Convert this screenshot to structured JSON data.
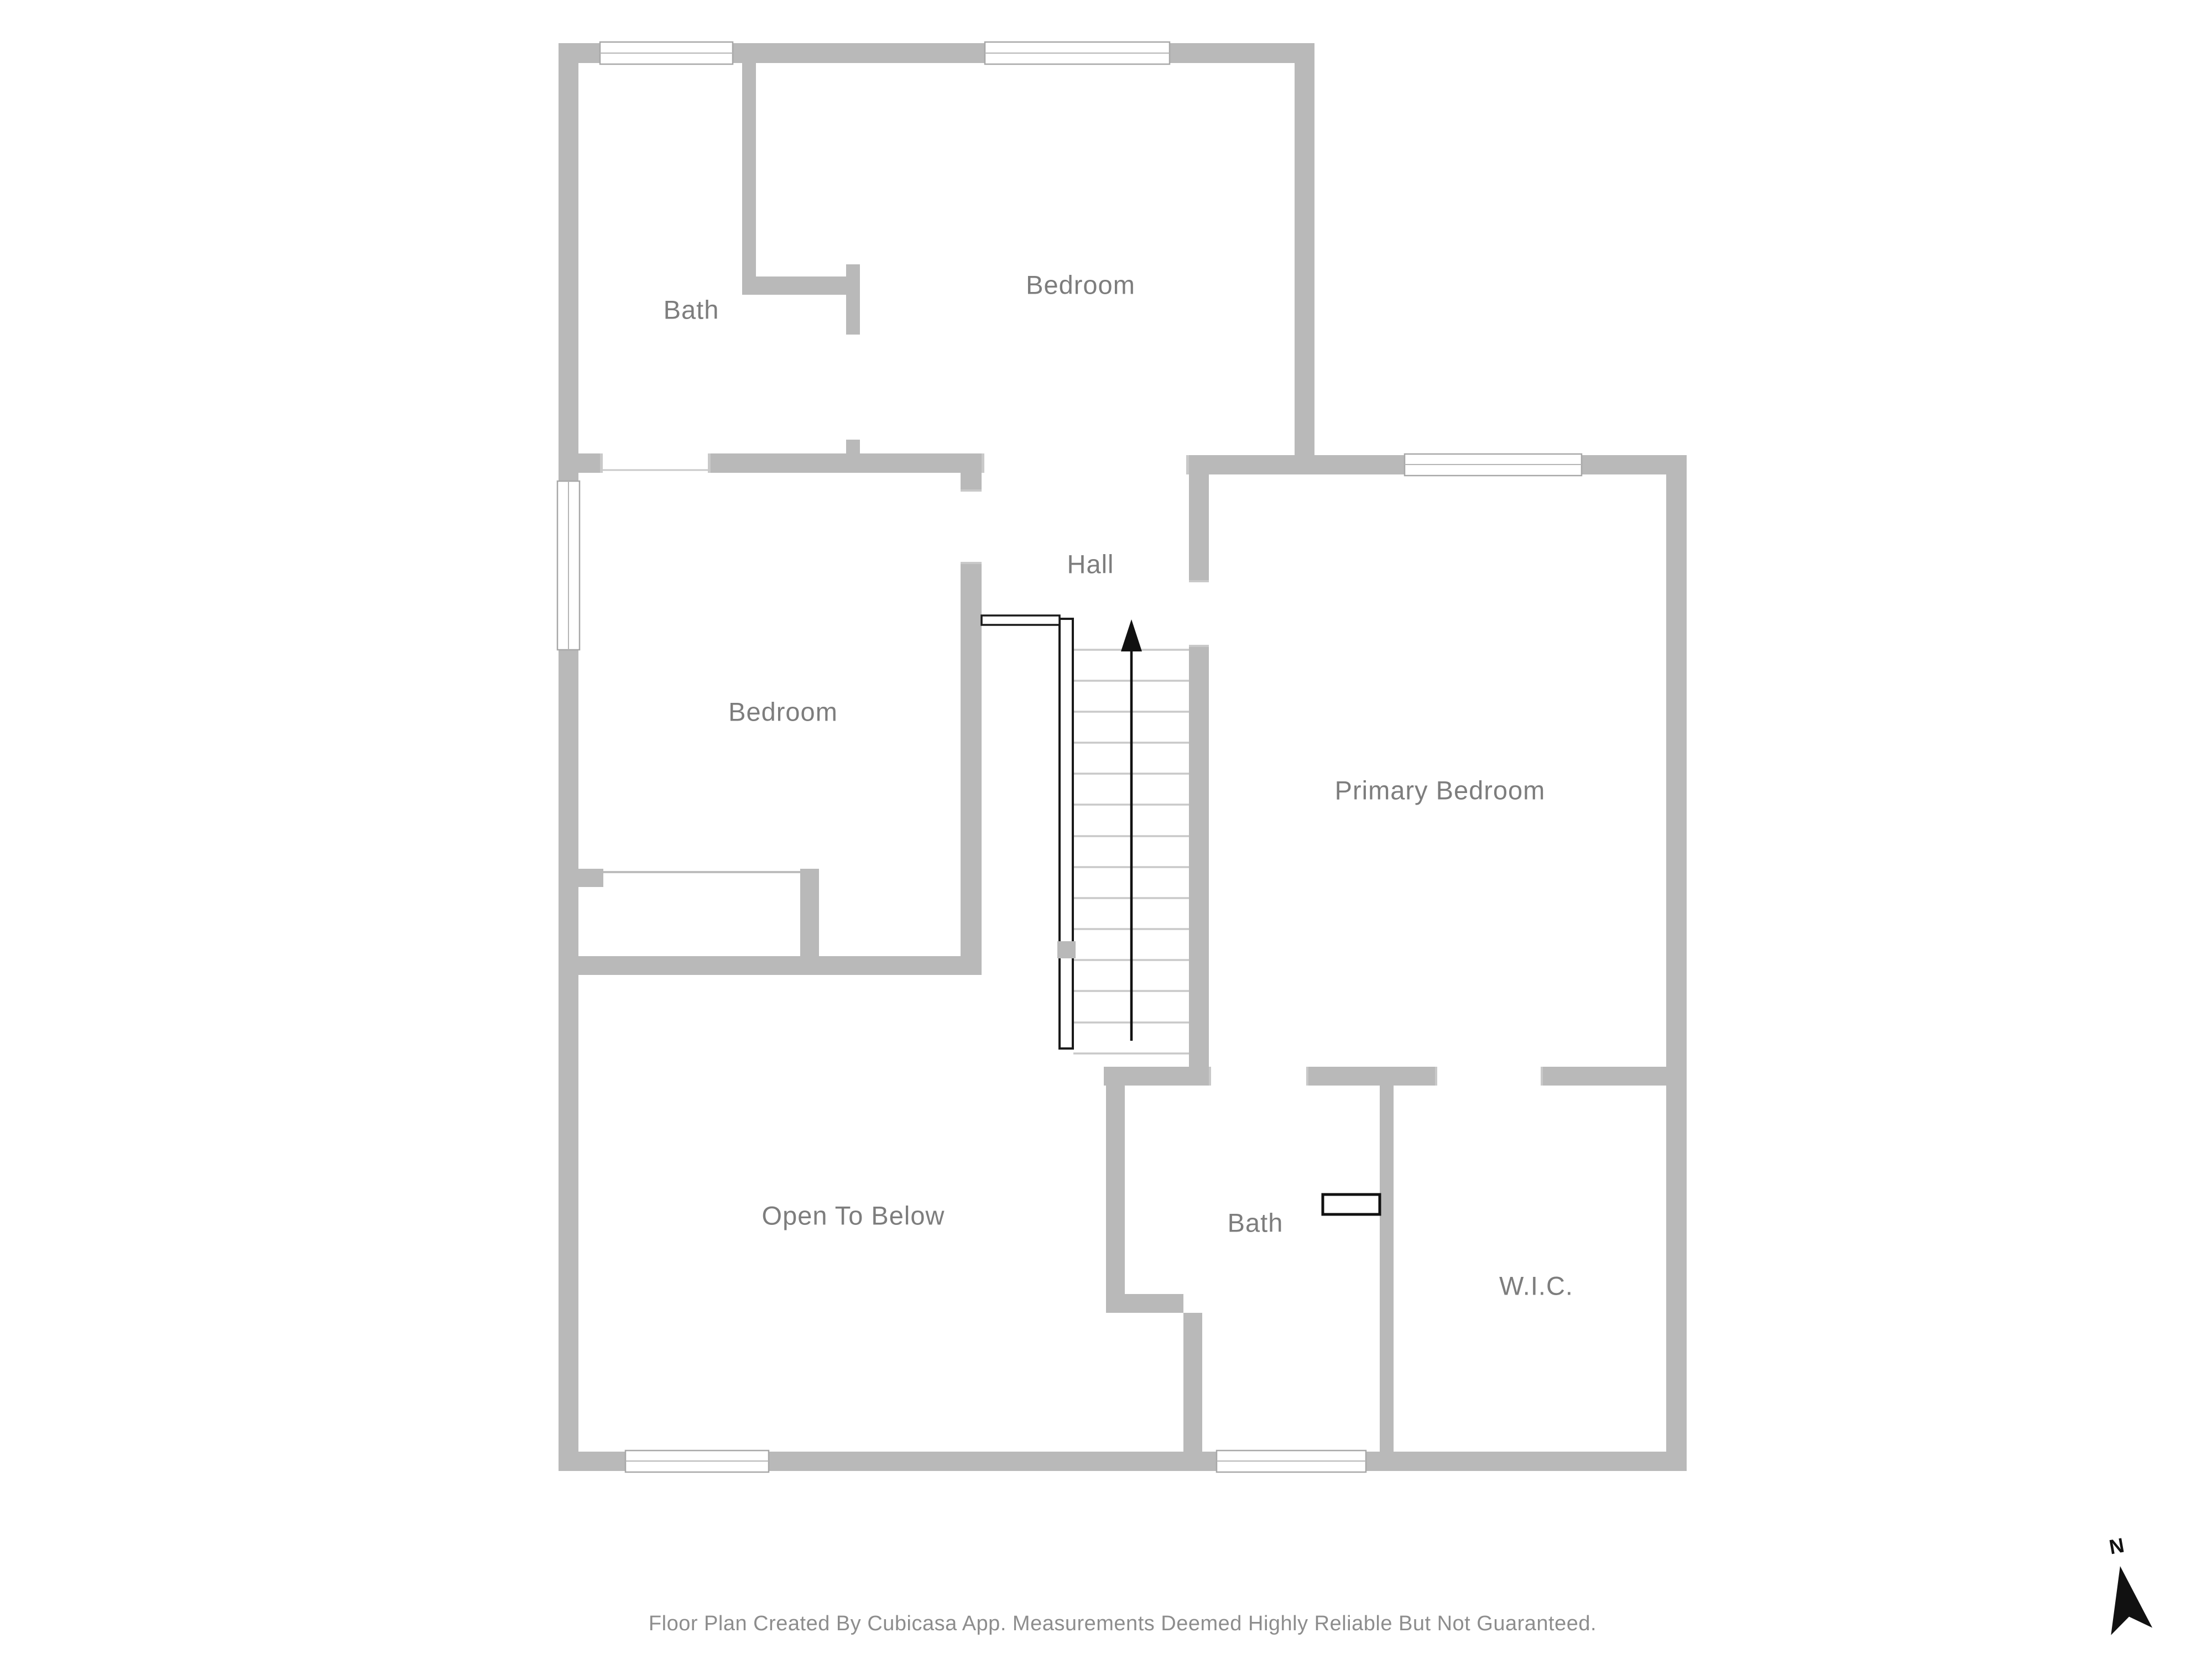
{
  "floor_plan": {
    "rooms": [
      {
        "id": "bath-upper",
        "label": "Bath"
      },
      {
        "id": "bedroom-upper",
        "label": "Bedroom"
      },
      {
        "id": "bedroom-middle",
        "label": "Bedroom"
      },
      {
        "id": "hall",
        "label": "Hall"
      },
      {
        "id": "primary-bedroom",
        "label": "Primary Bedroom"
      },
      {
        "id": "open-to-below",
        "label": "Open To Below"
      },
      {
        "id": "bath-lower",
        "label": "Bath"
      },
      {
        "id": "wic",
        "label": "W.I.C."
      }
    ],
    "stairs": {
      "direction_arrow": "up"
    },
    "compass": {
      "label": "N"
    },
    "footer": {
      "disclaimer": "Floor Plan Created By Cubicasa App. Measurements Deemed Highly Reliable But Not Guaranteed."
    },
    "colors": {
      "wall": "#b9b9b9",
      "room_fill": "#ffffff",
      "label_text": "#7d7d7d",
      "footer_text": "#8d8d8d",
      "railing": "#1a1a1a",
      "stair_tread": "#c9c9c9",
      "window_frame": "#a8a8a8"
    }
  }
}
